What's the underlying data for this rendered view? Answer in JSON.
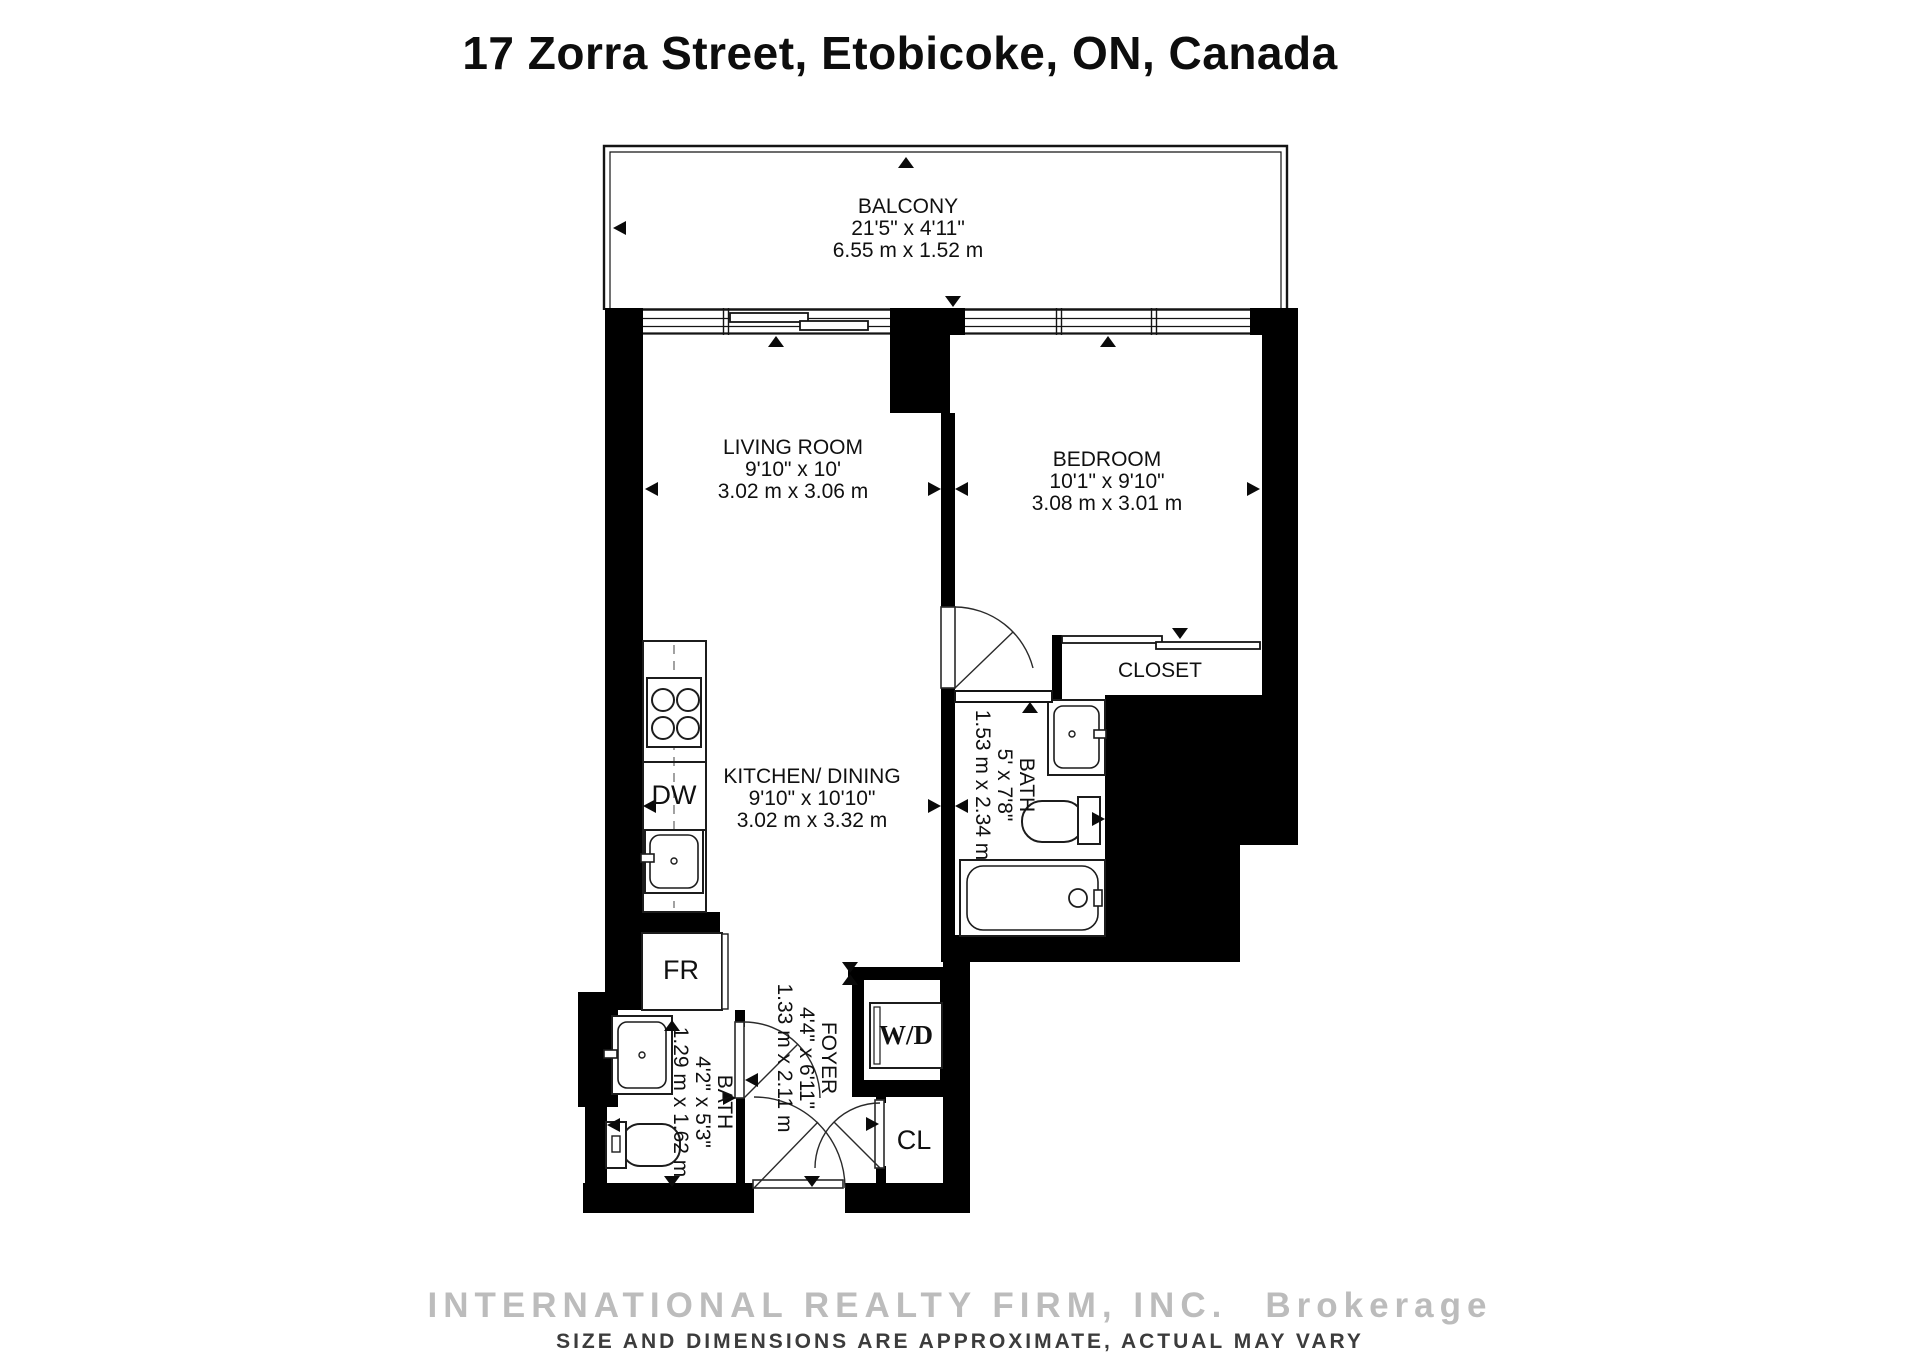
{
  "page": {
    "title": "17 Zorra Street, Etobicoke, ON, Canada"
  },
  "rooms": {
    "balcony": {
      "name": "BALCONY",
      "size_ft": "21'5\" x 4'11\"",
      "size_m": "6.55 m x 1.52 m"
    },
    "living_room": {
      "name": "LIVING ROOM",
      "size_ft": "9'10\" x 10'",
      "size_m": "3.02 m x 3.06 m"
    },
    "bedroom": {
      "name": "BEDROOM",
      "size_ft": "10'1\" x 9'10\"",
      "size_m": "3.08 m x 3.01 m"
    },
    "kitchen_dining": {
      "name": "KITCHEN/ DINING",
      "size_ft": "9'10\" x 10'10\"",
      "size_m": "3.02 m x 3.32 m"
    },
    "bath_ensuite": {
      "name": "BATH",
      "size_ft": "5' x 7'8\"",
      "size_m": "1.53 m x 2.34 m"
    },
    "bath_second": {
      "name": "BATH",
      "size_ft": "4'2\" x 5'3\"",
      "size_m": "1.29 m x 1.62 m"
    },
    "foyer": {
      "name": "FOYER",
      "size_ft": "4'4\" x 6'11\"",
      "size_m": "1.33 m x 2.11 m"
    },
    "closet": {
      "name": "CLOSET"
    }
  },
  "fixtures": {
    "washer_dryer": "W/D",
    "fridge": "FR",
    "dishwasher": "DW",
    "closet_small": "CL"
  },
  "footer": {
    "brand": "INTERNATIONAL REALTY FIRM, INC.",
    "brand_suffix": "Brokerage",
    "disclaimer": "SIZE AND DIMENSIONS ARE APPROXIMATE, ACTUAL MAY VARY"
  },
  "colors": {
    "wall": "#000000",
    "outline": "#1c1c1c",
    "watermark_light": "#bcbcbc",
    "watermark_dark": "#3c3c3c"
  }
}
